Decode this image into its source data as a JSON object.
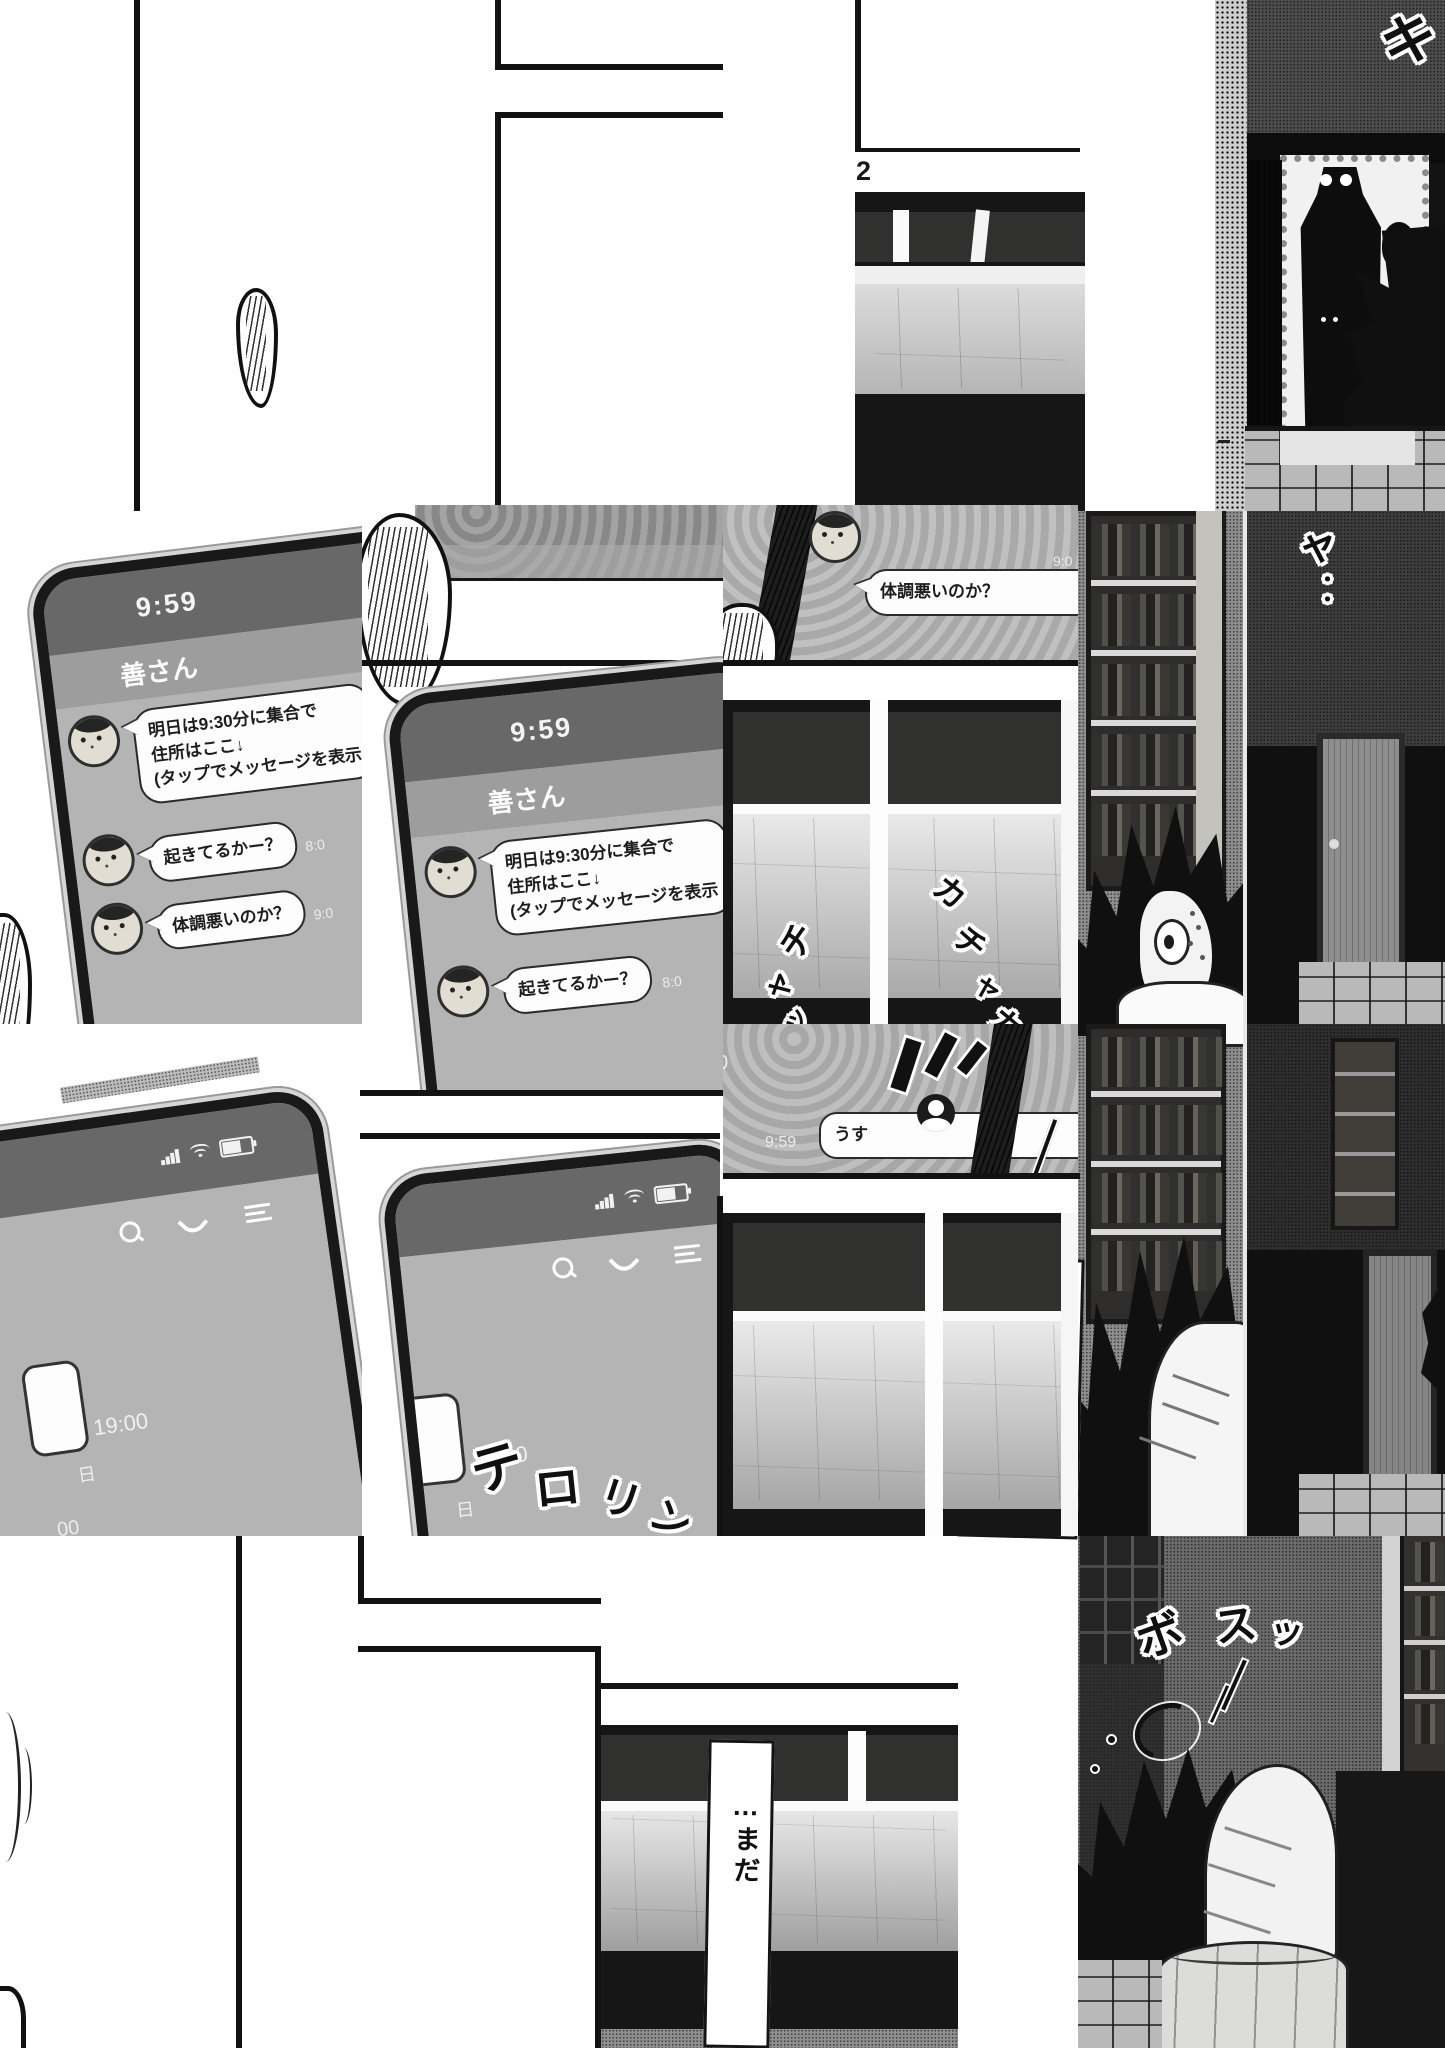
{
  "page": {
    "number": "2"
  },
  "chat_app": {
    "status_time": "9:59",
    "contact_name": "善さん",
    "message1_line1": "明日は9:30分に集合で",
    "message1_line2": "住所はここ↓",
    "message1_line3": "(タップでメッセージを表示",
    "message2": "起きてるかー？",
    "message3": "体調悪いのか？",
    "timestamp_now": "今",
    "timestamp_8": "8:0",
    "timestamp_9": "9:0",
    "reply_message": "うす",
    "reply_timestamp": "9:59"
  },
  "home_screen": {
    "event_time": "19:00",
    "day_label": "日",
    "minute_fragment": "00",
    "zero_fragment": "0"
  },
  "dialogue": {
    "main_part1_base": "出",
    "main_part1_ruby": "で",
    "main_part2": "かけられる",
    "main_part3_base": "気分",
    "main_part3_ruby": "きぶん",
    "main_part4": "じゃ・・・",
    "secondary": "…まだ"
  },
  "sfx": {
    "door_ki": "キ",
    "door_ya": "ャ",
    "door_dots": "・・",
    "kacha_0": "カ",
    "kacha_1": "チ",
    "kacha_2": "ャ",
    "kacha_3": "カ",
    "cha_0": "チ",
    "cha_1": "ャ",
    "cha_2": "ッ",
    "noti_0": "テ",
    "noti_1": "ロ",
    "noti_2": "リ",
    "noti_3": "ン",
    "flop_0": "ボ",
    "flop_1": "ス",
    "flop_2": "ッ"
  }
}
